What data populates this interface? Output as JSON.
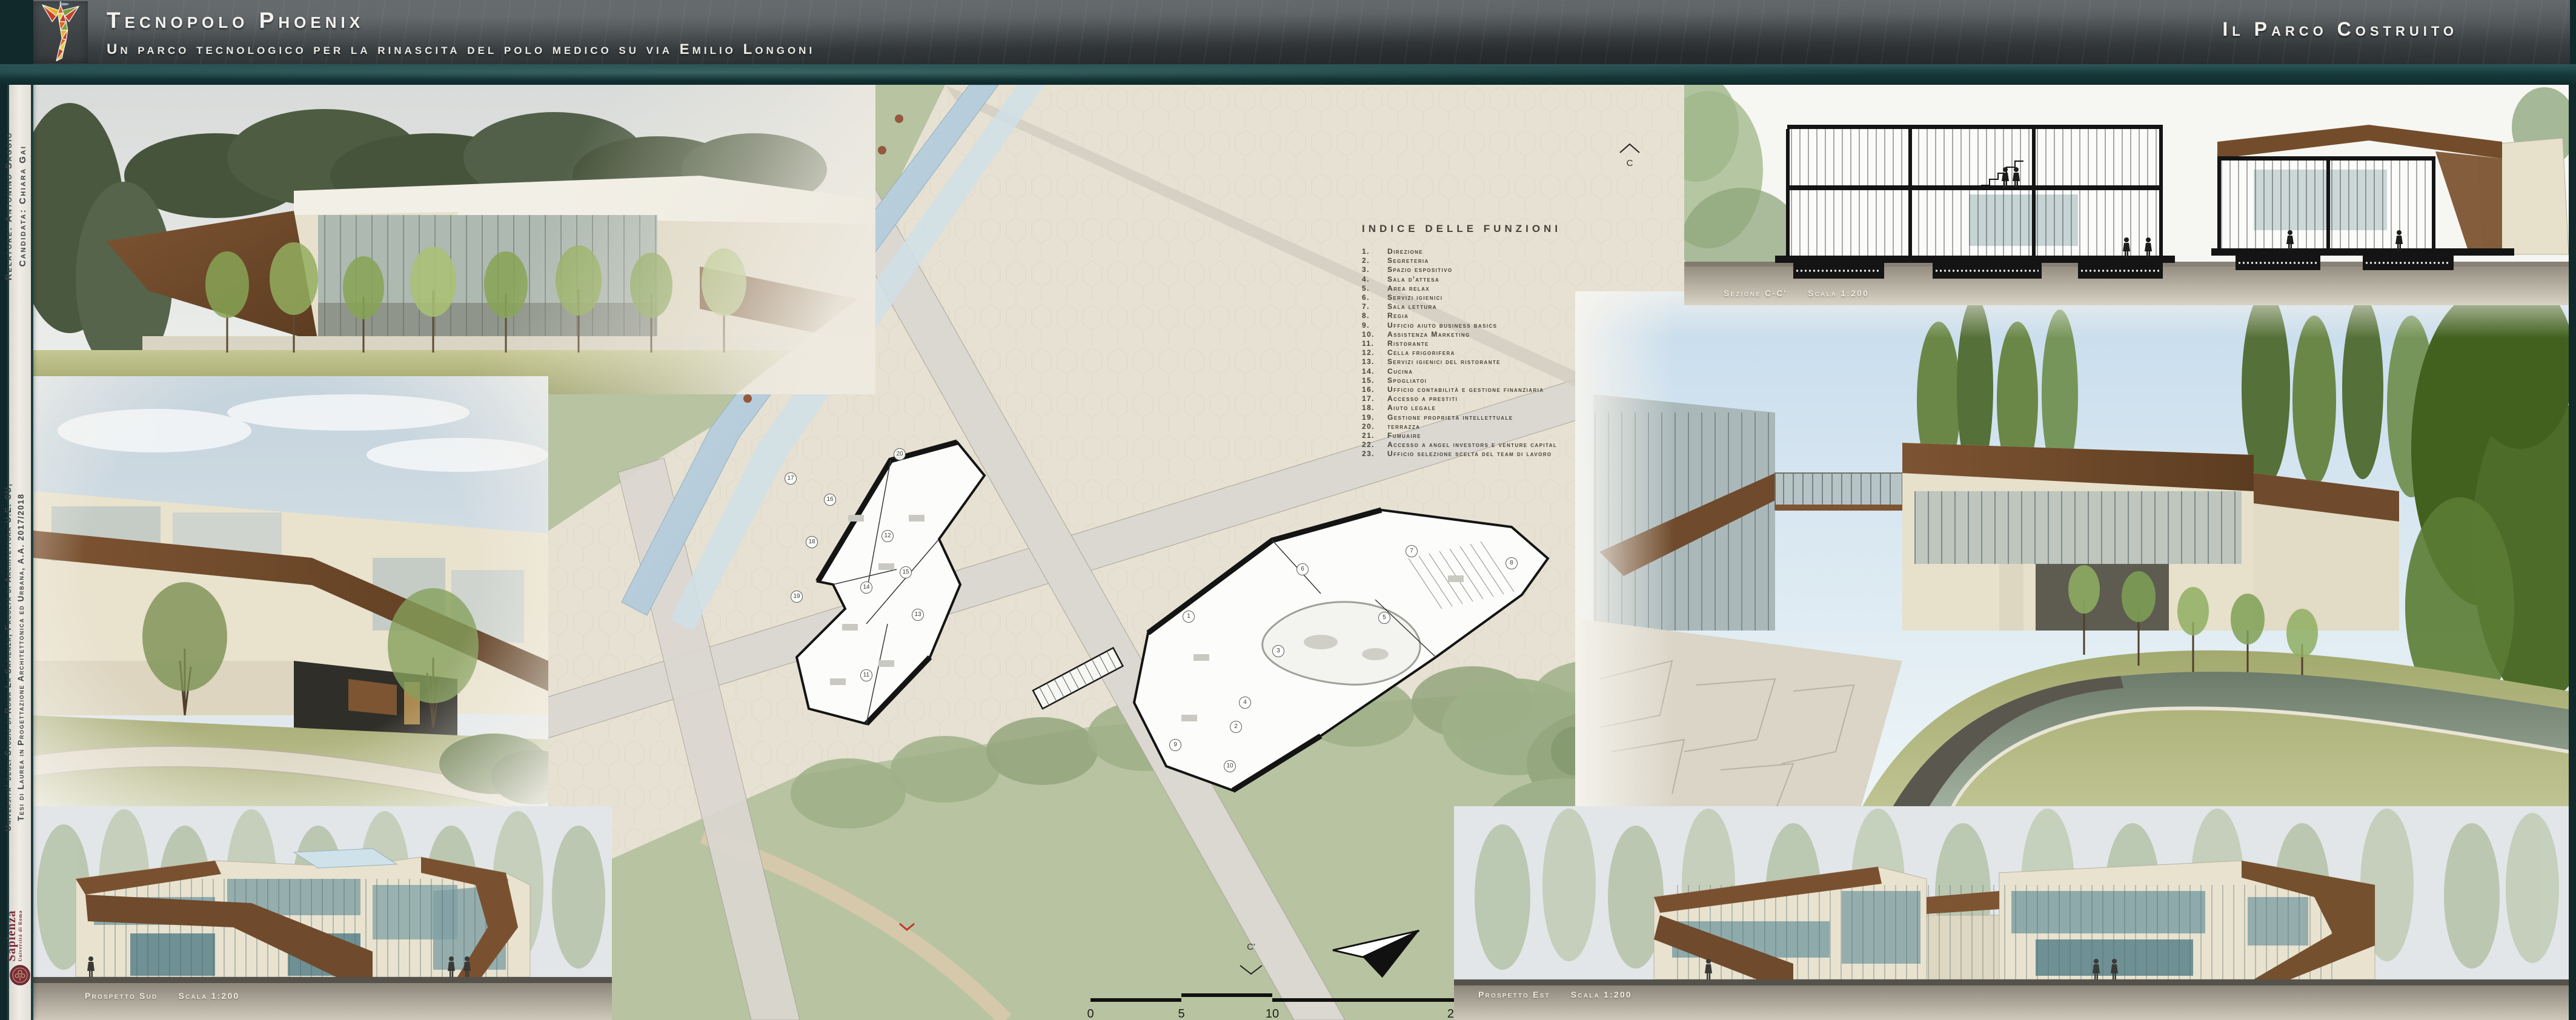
{
  "header": {
    "title": "Tecnopolo Phoenix",
    "subtitle": "Un parco tecnologico per la rinascita del polo medico su via Emilio Longoni",
    "right_title": "Il Parco Costruito"
  },
  "sidebar": {
    "credits_line1": "Relatore: Antonino Saggio",
    "credits_line2": "Candidata: Chiara Gai",
    "university_line1": "Università' degli Studio di Roma La Sapienza, Facoltà di Architettura U.E. CU,",
    "university_line2": "Tesi di Laurea in Progettazione Architettonica ed Urbana, A.A. 2017/2018",
    "sapienza_wordmark": "Sapienza",
    "sapienza_subtext": "Università di Roma"
  },
  "function_index": {
    "title": "Indice delle funzioni",
    "items": [
      "Direzione",
      "Segreteria",
      "Spazio espositivo",
      "Sala d'attesa",
      "Area relax",
      "Servizi igienici",
      "Sala lettura",
      "Regia",
      "Ufficio aiuto business basics",
      "Assistenza Marketing",
      "Ristorante",
      "Cella frigorifera",
      "Servizi igienici del ristorante",
      "Cucina",
      "Spogliatoi",
      "Ufficio contabilità e gestione finanziaria",
      "Accesso a prestiti",
      "Aiuto legale",
      "Gestione proprietà intellettuale",
      "terrazza",
      "Fumuaire",
      "Accesso a angel investors e venture capital",
      "Ufficio selezione scelta del team di lavoro"
    ]
  },
  "masterplan": {
    "room_numbers": [
      "1",
      "2",
      "3",
      "4",
      "5",
      "6",
      "7",
      "8",
      "9",
      "10",
      "11",
      "12",
      "13",
      "14",
      "15",
      "16",
      "17",
      "18",
      "19",
      "20",
      "21",
      "22",
      "23"
    ],
    "section_markers": [
      "C",
      "C'"
    ],
    "scale_bar": {
      "ticks": [
        "0",
        "5",
        "10",
        "20"
      ]
    }
  },
  "drawings": {
    "section_label": "Sezione C-C'",
    "section_scale": "Scala 1:200",
    "south_label": "Prospetto Sud",
    "south_scale": "Scala 1:200",
    "east_label": "Prospetto Est",
    "east_scale": "Scala 1:200"
  },
  "colors": {
    "header_dark": "#3c4043",
    "frame_teal": "#16393b",
    "parchment": "#e9e6dd",
    "plan_paving": "#e6e1d2",
    "plan_green": "#b8c3a1",
    "canal_blue": "#b6cbd9",
    "wood_brown": "#6f4a2a",
    "glass_teal": "#7fa0a4",
    "sky_blue": "#c7dcec",
    "grass_green": "#a8ad74",
    "ground_strip": "#55524c",
    "tree_dot_red": "#96573d",
    "sapienza_red": "#7a2c39"
  }
}
